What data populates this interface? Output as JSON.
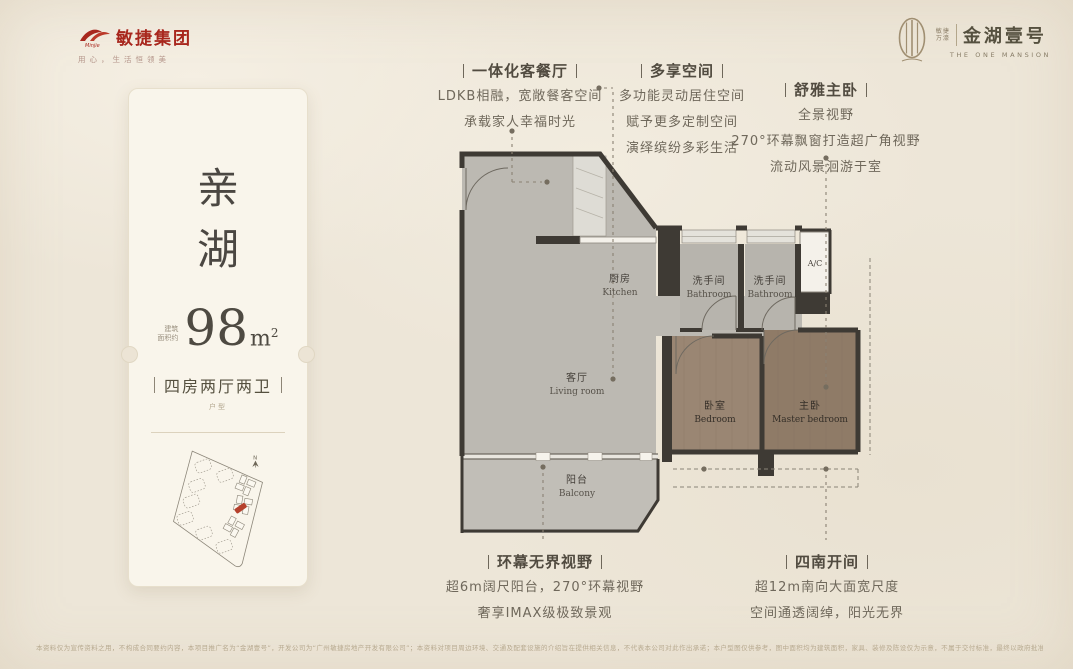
{
  "header": {
    "brand_left": {
      "name": "敏捷集团",
      "logo_script": "Minjie",
      "tagline": "用心，生活恒领美",
      "logo_color": "#a8271d"
    },
    "brand_right": {
      "sub_line1": "敏捷",
      "sub_line2": "万濠",
      "name": "金湖壹号",
      "name_en": "THE ONE MANSION",
      "emblem_color": "#a08f72"
    }
  },
  "unit_card": {
    "name": "亲湖",
    "area_prefix": [
      "建筑",
      "面积约"
    ],
    "area_value": "98",
    "area_unit_base": "m",
    "area_unit_sup": "2",
    "layout": "四房两厅两卫",
    "layout_note": "户型",
    "north_label": "N"
  },
  "floorplan": {
    "ac_label": "A/C",
    "rooms": [
      {
        "zh": "厨房",
        "en": "Kitchen"
      },
      {
        "zh": "洗手间",
        "en": "Bathroom"
      },
      {
        "zh": "洗手间",
        "en": "Bathroom"
      },
      {
        "zh": "客厅",
        "en": "Living room"
      },
      {
        "zh": "阳台",
        "en": "Balcony"
      },
      {
        "zh": "卧室",
        "en": "Bedroom"
      },
      {
        "zh": "主卧",
        "en": "Master bedroom"
      }
    ]
  },
  "annotations": [
    {
      "title": "一体化客餐厅",
      "lines": [
        "LDKB相融，宽敞餐客空间",
        "承载家人幸福时光"
      ]
    },
    {
      "title": "多享空间",
      "lines": [
        "多功能灵动居住空间",
        "赋予更多定制空间",
        "演绎缤纷多彩生活"
      ]
    },
    {
      "title": "舒雅主卧",
      "lines": [
        "全景视野",
        "270°环幕飘窗打造超广角视野",
        "流动风景洄游于室"
      ]
    },
    {
      "title": "环幕无界视野",
      "lines": [
        "超6m阔尺阳台，270°环幕视野",
        "奢享IMAX级极致景观"
      ]
    },
    {
      "title": "四南开间",
      "lines": [
        "超12m南向大面宽尺度",
        "空间通透阔绰，阳光无界"
      ]
    }
  ],
  "disclaimer": "本资料仅为宣传资料之用，不构成合同要约内容，本项目推广名为“金湖壹号”，开发公司为“广州敏捷房地产开发有限公司”；本资料对项目周边环境、交通及配套设施的介绍旨在提供相关信息，不代表本公司对此作出承诺；本户型图仅供参考，图中面积均为建筑面积，家具、装修及陈设仅为示意，不属于交付标准，最终以政府批准的图纸及商品房买卖合同约定为准；部分图片来源于网络，敬请留意。",
  "colors": {
    "accent_red": "#a8271d",
    "bronze": "#a08f72",
    "wall": "#3e3a34",
    "floor_gray": "#bcb9b2",
    "wood": "#9a8673",
    "wood_dark": "#8f7b67",
    "highlight_unit_red": "#b5402c"
  }
}
